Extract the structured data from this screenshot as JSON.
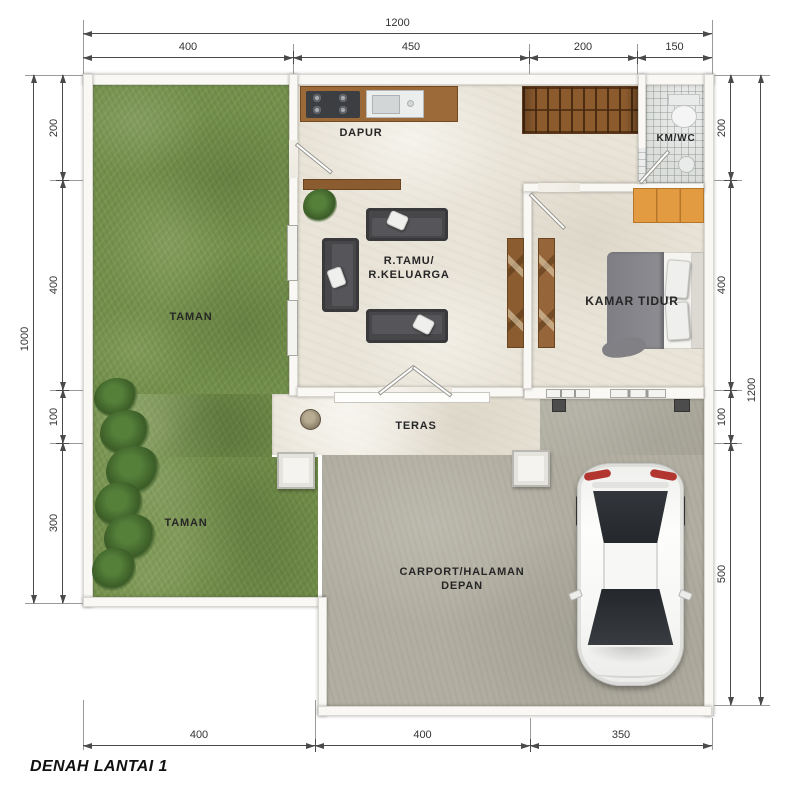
{
  "title": "DENAH LANTAI 1",
  "labels": {
    "taman_upper": "TAMAN",
    "taman_lower": "TAMAN",
    "dapur": "DAPUR",
    "km_wc": "KM/WC",
    "rtamu_line1": "R.TAMU/",
    "rtamu_line2": "R.KELUARGA",
    "kamar_tidur": "KAMAR TIDUR",
    "teras": "TERAS",
    "carport_line1": "CARPORT/HALAMAN",
    "carport_line2": "DEPAN"
  },
  "dimensions": {
    "top_total": "1200",
    "top_segments": [
      "400",
      "450",
      "200",
      "150"
    ],
    "left_total": "1000",
    "left_segments": [
      "200",
      "400",
      "100",
      "300"
    ],
    "right_total": "1200",
    "right_segments": [
      "200",
      "400",
      "100",
      "500"
    ],
    "bottom_segments": [
      "400",
      "400",
      "350"
    ]
  },
  "colors": {
    "grass": "#74904c",
    "floor_tile": "#e9e4d8",
    "carport_concrete": "#b2afa2",
    "wood": "#8a5c30",
    "dresser_orange": "#e29b41",
    "sofa": "#47474a",
    "dimension_line": "#4a4a4a"
  }
}
